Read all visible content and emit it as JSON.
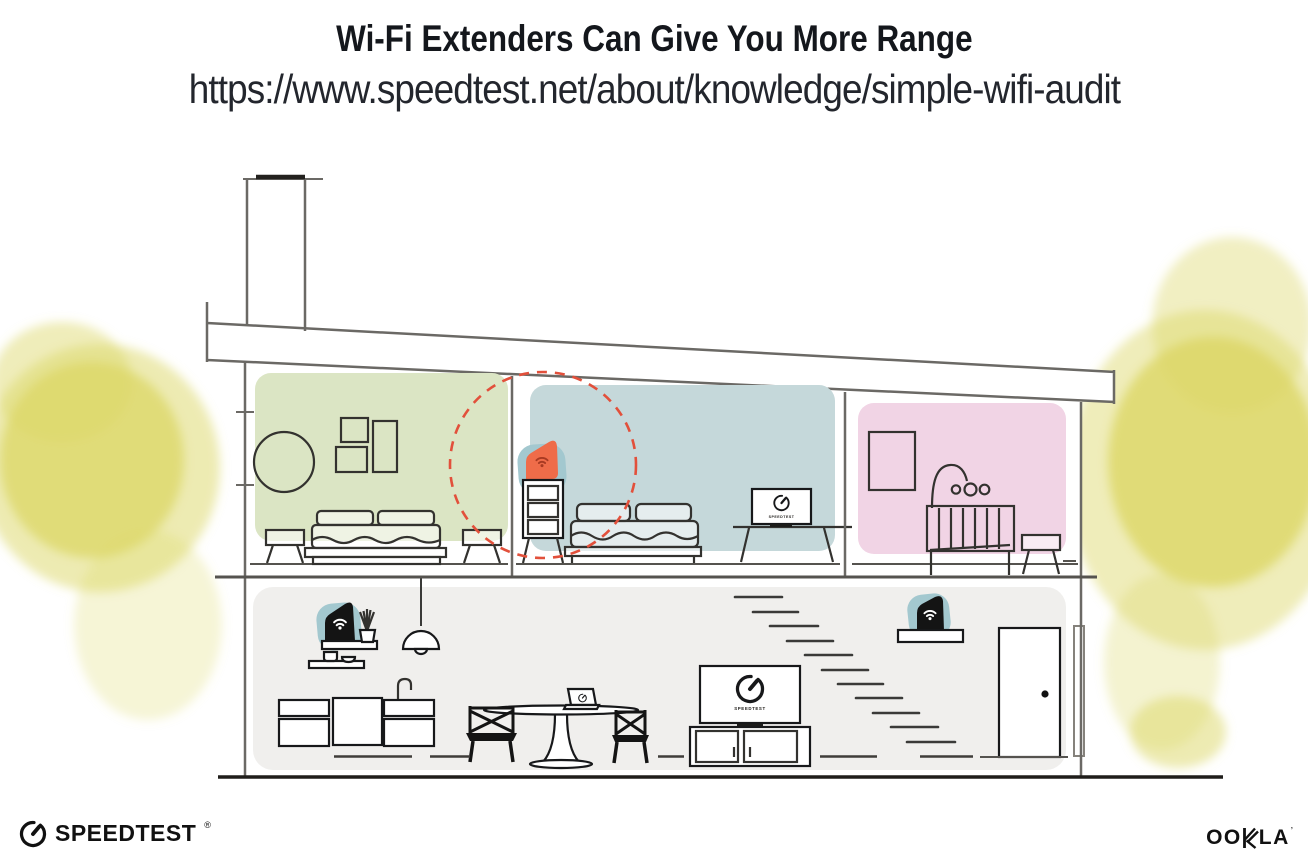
{
  "header": {
    "title": "Wi-Fi Extenders Can Give You More Range",
    "url": "https://www.speedtest.net/about/knowledge/simple-wifi-audit"
  },
  "illustration": {
    "type": "house-cutaway-wifi-coverage",
    "devices": [
      {
        "id": "wifi-router-downstairs",
        "style": "black-on-teal"
      },
      {
        "id": "wifi-extender-upstairs",
        "style": "orange",
        "highlighted_with": "red-dashed-range-circle"
      },
      {
        "id": "wifi-extender-downstairs",
        "style": "black-on-teal"
      }
    ],
    "screen_labels": {
      "bedroom_tv": "SPEEDTEST",
      "living_tv": "SPEEDTEST"
    }
  },
  "footer": {
    "speedtest_wordmark": "SPEEDTEST",
    "speedtest_reg": "®",
    "ookla_oo": "OO",
    "ookla_la": "LA",
    "ookla_mark": "’"
  },
  "colors": {
    "accent_orange": "#ef6c49",
    "range_circle_red": "#e2503b",
    "device_teal": "#a3c8cf",
    "room_green": "#dbe5c4",
    "room_blue": "#c5d8da",
    "room_pink": "#f1d4e5",
    "floor_gray": "#f0efed",
    "foliage_yellow": "#dcd766",
    "line_gray": "#6b6965",
    "ink_black": "#16181a"
  }
}
